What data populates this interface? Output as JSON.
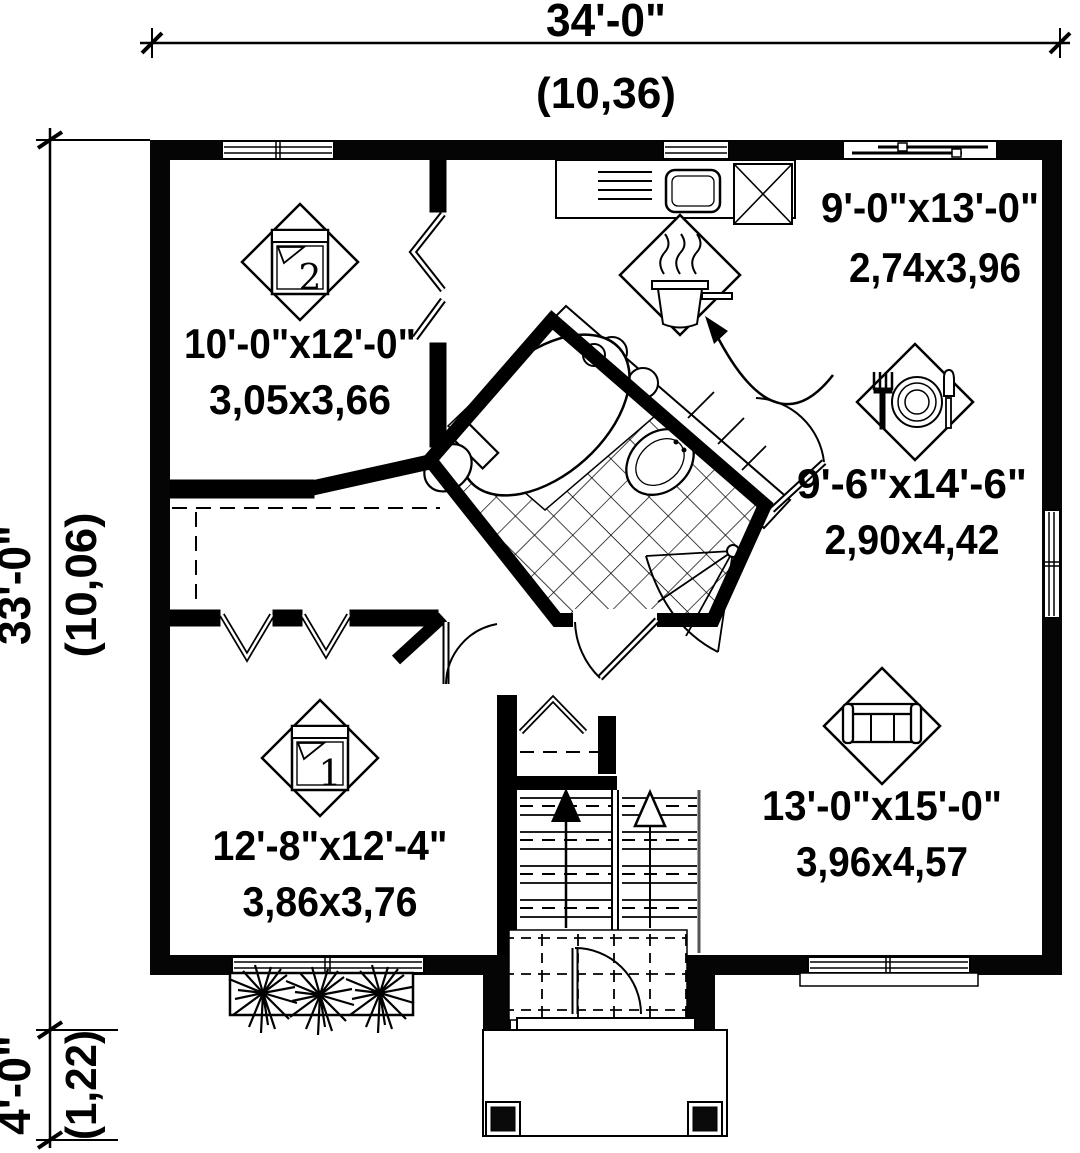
{
  "page": {
    "background": "#ffffff",
    "ink": "#000000",
    "drawing_type": "house floor plan"
  },
  "dimensions": {
    "top": {
      "imperial": "34'-0\"",
      "metric": "(10,36)"
    },
    "left": {
      "imperial": "33'-0\"",
      "metric": "(10,06)"
    },
    "bottom_left": {
      "imperial": "4'-0\"",
      "metric": "(1,22)"
    }
  },
  "rooms": {
    "bedroom2": {
      "number": "2",
      "size_imperial": "10'-0\"x12'-0\"",
      "size_metric": "3,05x3,66",
      "icon": "bed-number-2-icon"
    },
    "kitchen": {
      "size_imperial": "9'-0\"x13'-0\"",
      "size_metric": "2,74x3,96",
      "icon": "cooking-pot-icon"
    },
    "dining": {
      "size_imperial": "9'-6\"x14'-6\"",
      "size_metric": "2,90x4,42",
      "icon": "place-setting-icon"
    },
    "bedroom1": {
      "number": "1",
      "size_imperial": "12'-8\"x12'-4\"",
      "size_metric": "3,86x3,76",
      "icon": "bed-number-1-icon"
    },
    "living": {
      "size_imperial": "13'-0\"x15'-0\"",
      "size_metric": "3,96x4,57",
      "icon": "sofa-icon"
    }
  }
}
